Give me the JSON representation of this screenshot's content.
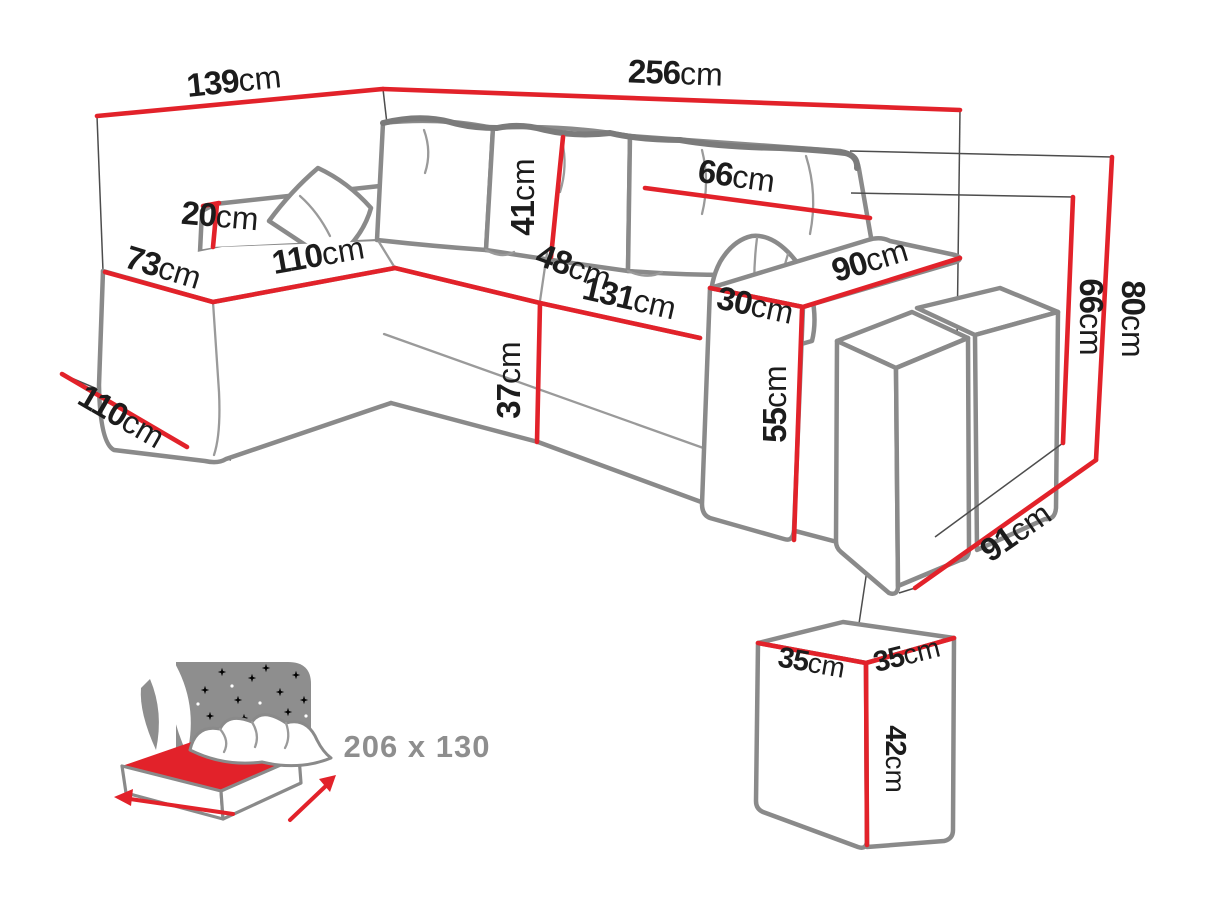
{
  "diagram": {
    "type": "furniture-dimension-diagram",
    "subject": "corner sofa bed with armrest poufs",
    "unit": "cm",
    "colors": {
      "dimension_line": "#e2222a",
      "outline_gray": "#8a8a8a",
      "label_text": "#1c1c1c",
      "icon_gray": "#8e8e8e"
    },
    "dims": {
      "back_width_left": {
        "value": "139",
        "unit": "cm"
      },
      "back_width_total": {
        "value": "256",
        "unit": "cm"
      },
      "back_cushion_width": {
        "value": "66",
        "unit": "cm"
      },
      "chaise_back_height": {
        "value": "20",
        "unit": "cm"
      },
      "chaise_end_width": {
        "value": "73",
        "unit": "cm"
      },
      "chaise_length": {
        "value": "110",
        "unit": "cm"
      },
      "back_cushion_height": {
        "value": "41",
        "unit": "cm"
      },
      "corner_seat_depth": {
        "value": "48",
        "unit": "cm"
      },
      "seat_width": {
        "value": "131",
        "unit": "cm"
      },
      "armrest_depth": {
        "value": "90",
        "unit": "cm"
      },
      "armrest_width": {
        "value": "30",
        "unit": "cm"
      },
      "seat_height": {
        "value": "37",
        "unit": "cm"
      },
      "armrest_height": {
        "value": "55",
        "unit": "cm"
      },
      "floor_depth_left": {
        "value": "110",
        "unit": "cm"
      },
      "backrest_height": {
        "value": "66",
        "unit": "cm"
      },
      "total_height": {
        "value": "80",
        "unit": "cm"
      },
      "floor_depth_right": {
        "value": "91",
        "unit": "cm"
      },
      "pouf_width": {
        "value": "35",
        "unit": "cm"
      },
      "pouf_depth": {
        "value": "35",
        "unit": "cm"
      },
      "pouf_height": {
        "value": "42",
        "unit": "cm"
      }
    },
    "sleeping_area": {
      "size": "206 x 130"
    }
  }
}
